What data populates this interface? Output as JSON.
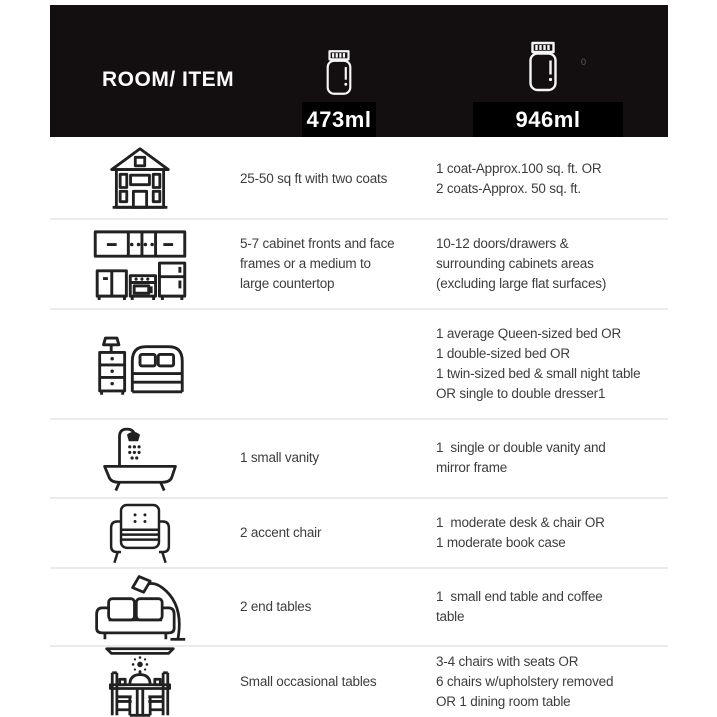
{
  "chart_data": {
    "type": "table",
    "title": "ROOM/ ITEM",
    "columns": [
      {
        "label": "473ml",
        "icon": "paint-jar-small-icon"
      },
      {
        "label": "946ml",
        "icon": "paint-jar-large-icon"
      }
    ],
    "rows": [
      {
        "icon": "house-icon",
        "c473": "25-50 sq ft with two coats",
        "c946": "1 coat-Approx.100 sq. ft. OR\n2 coats-Approx. 50 sq. ft."
      },
      {
        "icon": "kitchen-cabinets-icon",
        "c473": "5-7 cabinet fronts and face\nframes or a medium to\nlarge countertop",
        "c946": "10-12 doors/drawers &\nsurrounding cabinets areas\n(excluding large flat surfaces)"
      },
      {
        "icon": "bed-nightstand-icon",
        "c473": "",
        "c946": "1 average Queen-sized bed OR\n1 double-sized bed OR\n1 twin-sized bed & small night table\nOR single to double dresser1"
      },
      {
        "icon": "bathtub-shower-icon",
        "c473": "1 small vanity",
        "c946": "1  single or double vanity and\nmirror frame"
      },
      {
        "icon": "accent-chair-icon",
        "c473": "2 accent chair",
        "c946": "1  moderate desk & chair OR\n1 moderate book case"
      },
      {
        "icon": "sofa-floor-lamp-icon",
        "c473": "2 end tables",
        "c946": "1  small end table and coffee\ntable"
      },
      {
        "icon": "dining-table-icon",
        "c473": "Small occasional tables",
        "c946": "3-4 chairs with seats OR\n6 chairs w/upholstery removed\nOR 1 dining room table"
      }
    ]
  },
  "header": {
    "stray_mark": "0"
  },
  "colors": {
    "header_bg": "#130e0f",
    "badge_bg": "#000000",
    "header_text": "#ffffff",
    "body_text": "#3d3d3d",
    "divider": "#ebebeb",
    "icon_stroke": "#212121"
  }
}
